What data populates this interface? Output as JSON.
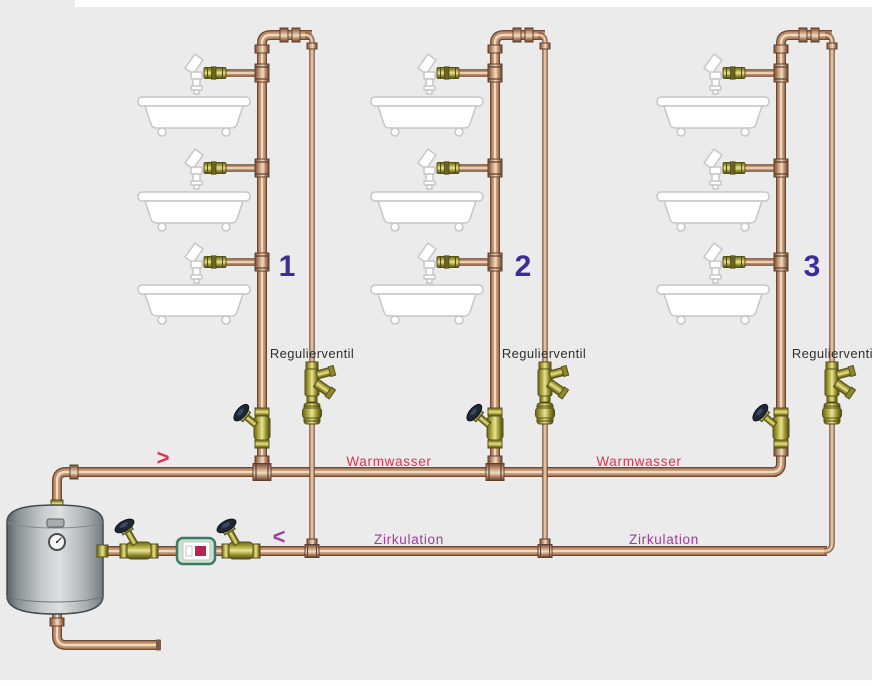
{
  "diagram": {
    "background_color": "#ebebeb",
    "risers": [
      {
        "number": "1",
        "valve_label": "Regulierventil",
        "floors": 3
      },
      {
        "number": "2",
        "valve_label": "Regulierventil",
        "floors": 3
      },
      {
        "number": "3",
        "valve_label": "Regulierventil",
        "floors": 3
      }
    ],
    "warmwasser": {
      "labels": [
        "Warmwasser",
        "Warmwasser"
      ],
      "arrow": ">",
      "color": "#e03050"
    },
    "zirkulation": {
      "labels": [
        "Zirkulation",
        "Zirkulation"
      ],
      "arrow": "<",
      "color": "#a03a9e"
    },
    "number_color": "#3a2d9b",
    "components": {
      "boiler": "hot-water-storage-tank",
      "pump": "circulation-pump",
      "shutoff_valve": "angle-seat-valve",
      "regulating_valve": "circulation-regulating-valve",
      "tap": "draw-off-tap",
      "tub": "bathtub"
    },
    "pipe_colors": {
      "copper": "#c08e68",
      "copper_dark": "#6a4836",
      "copper_highlight": "#eed9c1",
      "brass": "#cdc553"
    }
  }
}
